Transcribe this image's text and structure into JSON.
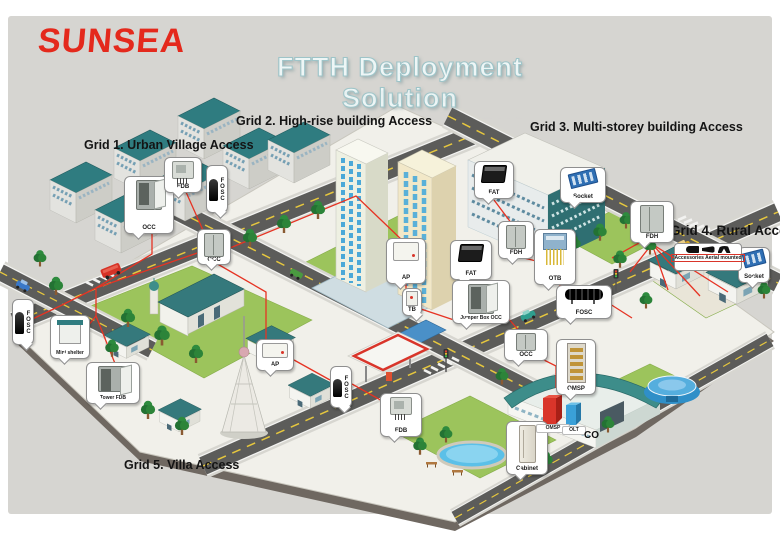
{
  "logo": {
    "text": "SUNSEA",
    "color": "#e4291c"
  },
  "title": {
    "text": "FTTH Deployment Solution"
  },
  "grids": [
    {
      "label": "Grid 1. Urban Village Access"
    },
    {
      "label": "Grid 2. High-rise building Access"
    },
    {
      "label": "Grid 3. Multi-storey building Access"
    },
    {
      "label": "Grid 4. Rural Access"
    },
    {
      "label": "Grid 5. Villa Access"
    }
  ],
  "callouts": [
    {
      "id": "occ-1",
      "label": "OCC",
      "icon": "cabinet-open-icon"
    },
    {
      "id": "fdb-1",
      "label": "FDB",
      "icon": "wall-box-icon"
    },
    {
      "id": "fosc-1",
      "label": "FOSC",
      "icon": "dome-closure-icon"
    },
    {
      "id": "occ-2",
      "label": "OCC",
      "icon": "cabinet-icon"
    },
    {
      "id": "ap-1",
      "label": "AP",
      "icon": "flat-box-icon"
    },
    {
      "id": "fat-1",
      "label": "FAT",
      "icon": "black-box-icon"
    },
    {
      "id": "tb-1",
      "label": "TB",
      "icon": "mini-box-icon"
    },
    {
      "id": "jumper-occ",
      "label": "Jumper Box OCC",
      "icon": "cabinet-open-icon"
    },
    {
      "id": "occ-3",
      "label": "OCC",
      "icon": "cabinet-icon"
    },
    {
      "id": "fat-2",
      "label": "FAT",
      "icon": "black-box-icon"
    },
    {
      "id": "socket-1",
      "label": "Socket",
      "icon": "blue-board-icon"
    },
    {
      "id": "fdh-1",
      "label": "FDH",
      "icon": "cabinet-icon"
    },
    {
      "id": "otb-1",
      "label": "OTB",
      "icon": "fiber-box-icon"
    },
    {
      "id": "fosc-2",
      "label": "FOSC",
      "icon": "cylinder-closure-icon"
    },
    {
      "id": "fdh-2",
      "label": "FDH",
      "icon": "cabinet-icon"
    },
    {
      "id": "socket-2",
      "label": "Socket",
      "icon": "blue-board-icon"
    },
    {
      "id": "ap-2",
      "label": "AP",
      "icon": "flat-box-icon"
    },
    {
      "id": "fosc-3",
      "label": "FOSC",
      "icon": "dome-closure-icon"
    },
    {
      "id": "fdb-2",
      "label": "FDB",
      "icon": "wall-box-icon"
    },
    {
      "id": "fosc-4",
      "label": "FOSC",
      "icon": "dome-closure-icon"
    },
    {
      "id": "mini-shelter",
      "label": "Mini shelter",
      "icon": "shelter-icon"
    },
    {
      "id": "tower-fdb",
      "label": "Tower FDB",
      "icon": "cabinet-open-icon"
    },
    {
      "id": "omsp",
      "label": "OMSP",
      "icon": "rack-icon"
    },
    {
      "id": "cabinet",
      "label": "Cabinet",
      "icon": "tall-cabinet-icon"
    }
  ],
  "accessories": {
    "label": "Accessories Aerial mounted"
  },
  "co_site": {
    "omsp_label": "OMSP",
    "olt_label": "OLT",
    "co_label": "CO"
  },
  "colors": {
    "panel_background": "#d6d5d1",
    "logo_red": "#e4291c",
    "fiber_line": "#e63323",
    "road": "#5c5c5a",
    "lawn": "#9cc45c",
    "roof_teal": "#2f7c80",
    "title_text": "#eef6f6"
  }
}
